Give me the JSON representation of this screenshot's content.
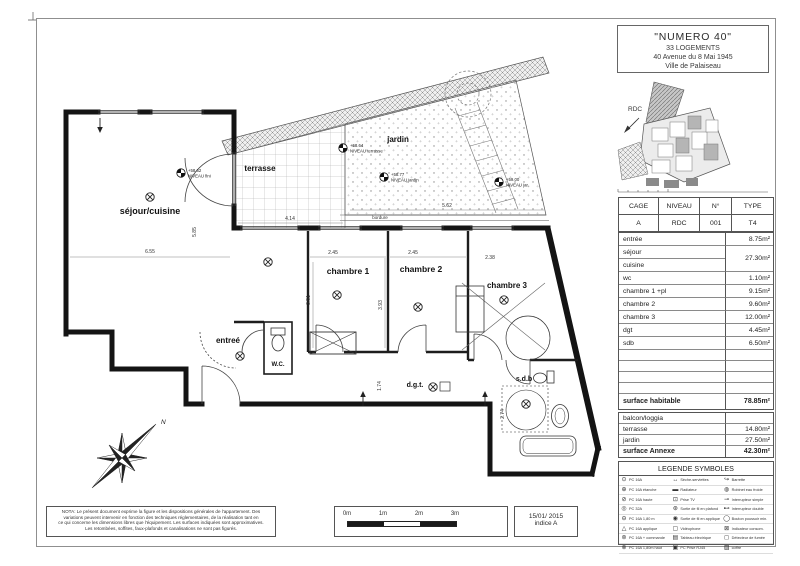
{
  "title_block": {
    "l1": "\"NUMERO 40\"",
    "l2": "33 LOGEMENTS",
    "l3": "40 Avenue du 8 Mai 1945",
    "l4": "Ville de Palaiseau"
  },
  "site_plan": {
    "label": "RDC"
  },
  "unit_table": {
    "h1": "CAGE",
    "h2": "NIVEAU",
    "h3": "N°",
    "h4": "TYPE",
    "v1": "A",
    "v2": "RDC",
    "v3": "001",
    "v4": "T4"
  },
  "surfaces": {
    "rows": [
      {
        "label": "entrée",
        "area": "8.75m²"
      },
      {
        "label": "séjour",
        "area": "27.30m²"
      },
      {
        "label": "cuisine",
        "area": ""
      },
      {
        "label": "wc",
        "area": "1.10m²"
      },
      {
        "label": "chambre 1 +pl",
        "area": "9.15m²"
      },
      {
        "label": "chambre 2",
        "area": "9.60m²"
      },
      {
        "label": "chambre 3",
        "area": "12.00m²"
      },
      {
        "label": "dgt",
        "area": "4.45m²"
      },
      {
        "label": "sdb",
        "area": "6.50m²"
      }
    ],
    "total": {
      "label": "surface habitable",
      "area": "78.85m²"
    },
    "annexe_rows": [
      {
        "label": "balcon/loggia",
        "area": ""
      },
      {
        "label": "terrasse",
        "area": "14.80m²"
      },
      {
        "label": "jardin",
        "area": "27.50m²"
      }
    ],
    "annexe_total": {
      "label": "surface Annexe",
      "area": "42.30m²"
    }
  },
  "legend": {
    "title": "LEGENDE SYMBOLES",
    "col1": [
      {
        "sym": "⊙",
        "label": "PC 16A"
      },
      {
        "sym": "⊕",
        "label": "PC 16A étanche"
      },
      {
        "sym": "⊘",
        "label": "PC 16A haute"
      },
      {
        "sym": "◎",
        "label": "PC 32A"
      },
      {
        "sym": "⊖",
        "label": "PC 16A 1,80 m"
      },
      {
        "sym": "△",
        "label": "PC 16A applique"
      },
      {
        "sym": "⊚",
        "label": "PC 16A + commande"
      },
      {
        "sym": "⊗",
        "label": "PC 16A 1,80m haut"
      }
    ],
    "col2": [
      {
        "sym": "↔",
        "label": "Sèche-serviettes"
      },
      {
        "sym": "▬",
        "label": "Radiateur"
      },
      {
        "sym": "⊡",
        "label": "Prise TV"
      },
      {
        "sym": "⊛",
        "label": "Sortie de fil en plafond"
      },
      {
        "sym": "◉",
        "label": "Sortie de fil en applique"
      },
      {
        "sym": "▢",
        "label": "Vidéophone"
      },
      {
        "sym": "▤",
        "label": "Tableau électrique"
      },
      {
        "sym": "▣",
        "label": "PC Prise RJ45"
      }
    ],
    "col3": [
      {
        "sym": "↪",
        "label": "Barrette"
      },
      {
        "sym": "◍",
        "label": "Robinet eau froide"
      },
      {
        "sym": "⊸",
        "label": "Interrupteur simple"
      },
      {
        "sym": "⊷",
        "label": "Interrupteur double"
      },
      {
        "sym": "◯",
        "label": "Bouton poussoir min."
      },
      {
        "sym": "⊠",
        "label": "Indicateur consom."
      },
      {
        "sym": "◻",
        "label": "Détecteur de fumée"
      },
      {
        "sym": "▨",
        "label": "coffre"
      }
    ]
  },
  "plan": {
    "rooms": {
      "sejour": "séjour/cuisine",
      "terrasse": "terrasse",
      "jardin": "jardin",
      "ch1": "chambre 1",
      "ch2": "chambre 2",
      "ch3": "chambre 3",
      "entree": "entreé",
      "wc": "W.C.",
      "dgt": "d.g.t.",
      "sdb": "s.d.b"
    },
    "dims": {
      "d655": "6.55",
      "d585": "5.85",
      "d414": "4.14",
      "d562": "5.62",
      "d245a": "2.45",
      "d245b": "2.45",
      "d238": "2.38",
      "d351": "3.51",
      "d393": "3.93",
      "d174": "1.74",
      "d274": "2.74"
    },
    "levels": {
      "l1a": "+58.62",
      "l1b": "NIVEAU fini",
      "l2a": "+58.64",
      "l2b": "NIVEAU terrasse",
      "l3a": "+58.77",
      "l3b": "NIVEAU jardin",
      "l4a": "+59.00",
      "l4b": "NIVEAU jar."
    },
    "bordure": "bordure",
    "north": "N"
  },
  "footer": {
    "nota_l1": "NOTA: Le présent document exprime la figure et les dispositions générales de l'appartement. Des",
    "nota_l2": "variations peuvent intervenir en fonction des  techniques réglementaires, de la réalisation tant en",
    "nota_l3": "ce qui concerne les dimensions libres que l'équipement. Les surfaces indiquées sont approximatives.",
    "nota_l4": "Les retombées, soffites, faux-plafonds et canalisations ne sont pas figurés.",
    "scale": {
      "t0": "0m",
      "t1": "1m",
      "t2": "2m",
      "t3": "3m"
    },
    "date": "15/01/ 2015",
    "indice": "indice A"
  }
}
